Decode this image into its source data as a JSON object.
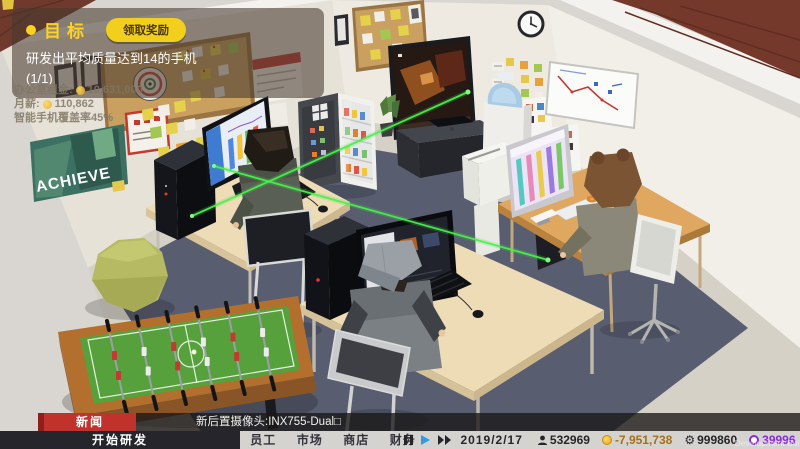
{
  "goal_panel": {
    "title": "目标",
    "claim_button": "领取奖励",
    "description": "研发出平均质量达到14的手机 (1/1)"
  },
  "hud_stats": {
    "rent_label": "办公室租金:",
    "rent_value": "10,631,000",
    "salary_label": "月薪:",
    "salary_value": "110,862",
    "coverage_label": "智能手机覆盖率45%"
  },
  "news": {
    "label": "新闻",
    "text": "新后置摄像头:INX755-Dual□"
  },
  "bottom_bar": {
    "start_research": "开始研发",
    "tabs": [
      "员工",
      "市场",
      "商店",
      "财务"
    ],
    "date": "2019/2/17",
    "fans": "532969",
    "money": "-7,951,738",
    "research_points": "999860",
    "premium": "39996"
  },
  "scene": {
    "poster_text": "ACHIEVE"
  },
  "watermark": "Development Build",
  "colors": {
    "accent_yellow": "#f2cf1d",
    "news_red": "#c2322c",
    "money_orange": "#a4701c",
    "premium_purple": "#8a2be2",
    "play_blue": "#2f9ce8",
    "carpet": "#585d70"
  }
}
